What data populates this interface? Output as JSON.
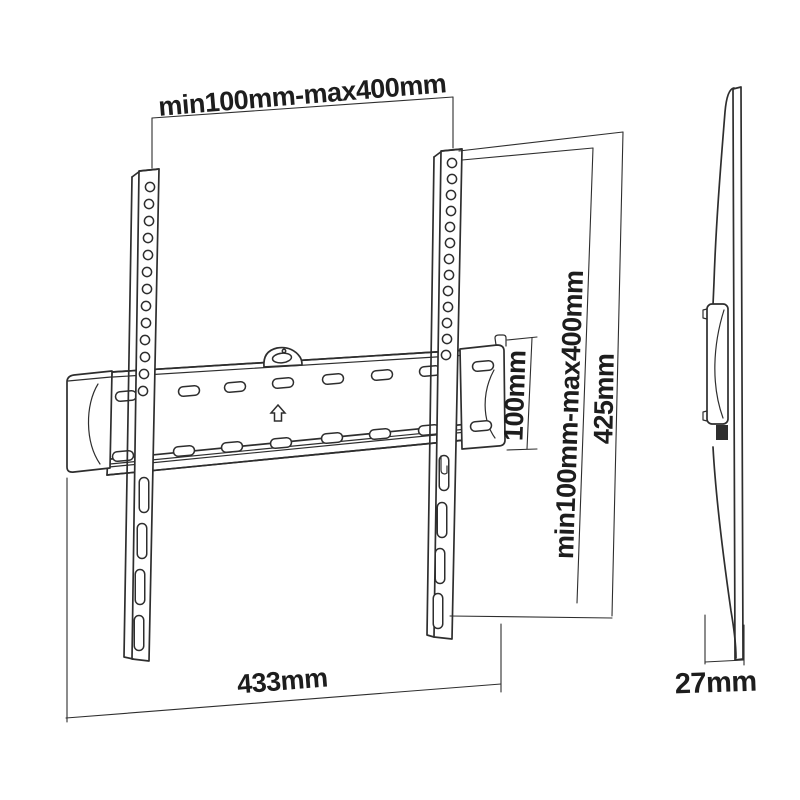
{
  "colors": {
    "background": "#ffffff",
    "line": "#2e2e2e",
    "text": "#1d1d1d"
  },
  "dimensions": {
    "vesa_width": "min100mm-max400mm",
    "plate_height": "100mm",
    "vesa_height": "min100mm-max400mm",
    "total_height": "425mm",
    "total_width": "433mm",
    "depth": "27mm"
  },
  "icons": {
    "up_arrow": "up-arrow-icon",
    "hanger_tab": "hanger-tab-icon"
  }
}
